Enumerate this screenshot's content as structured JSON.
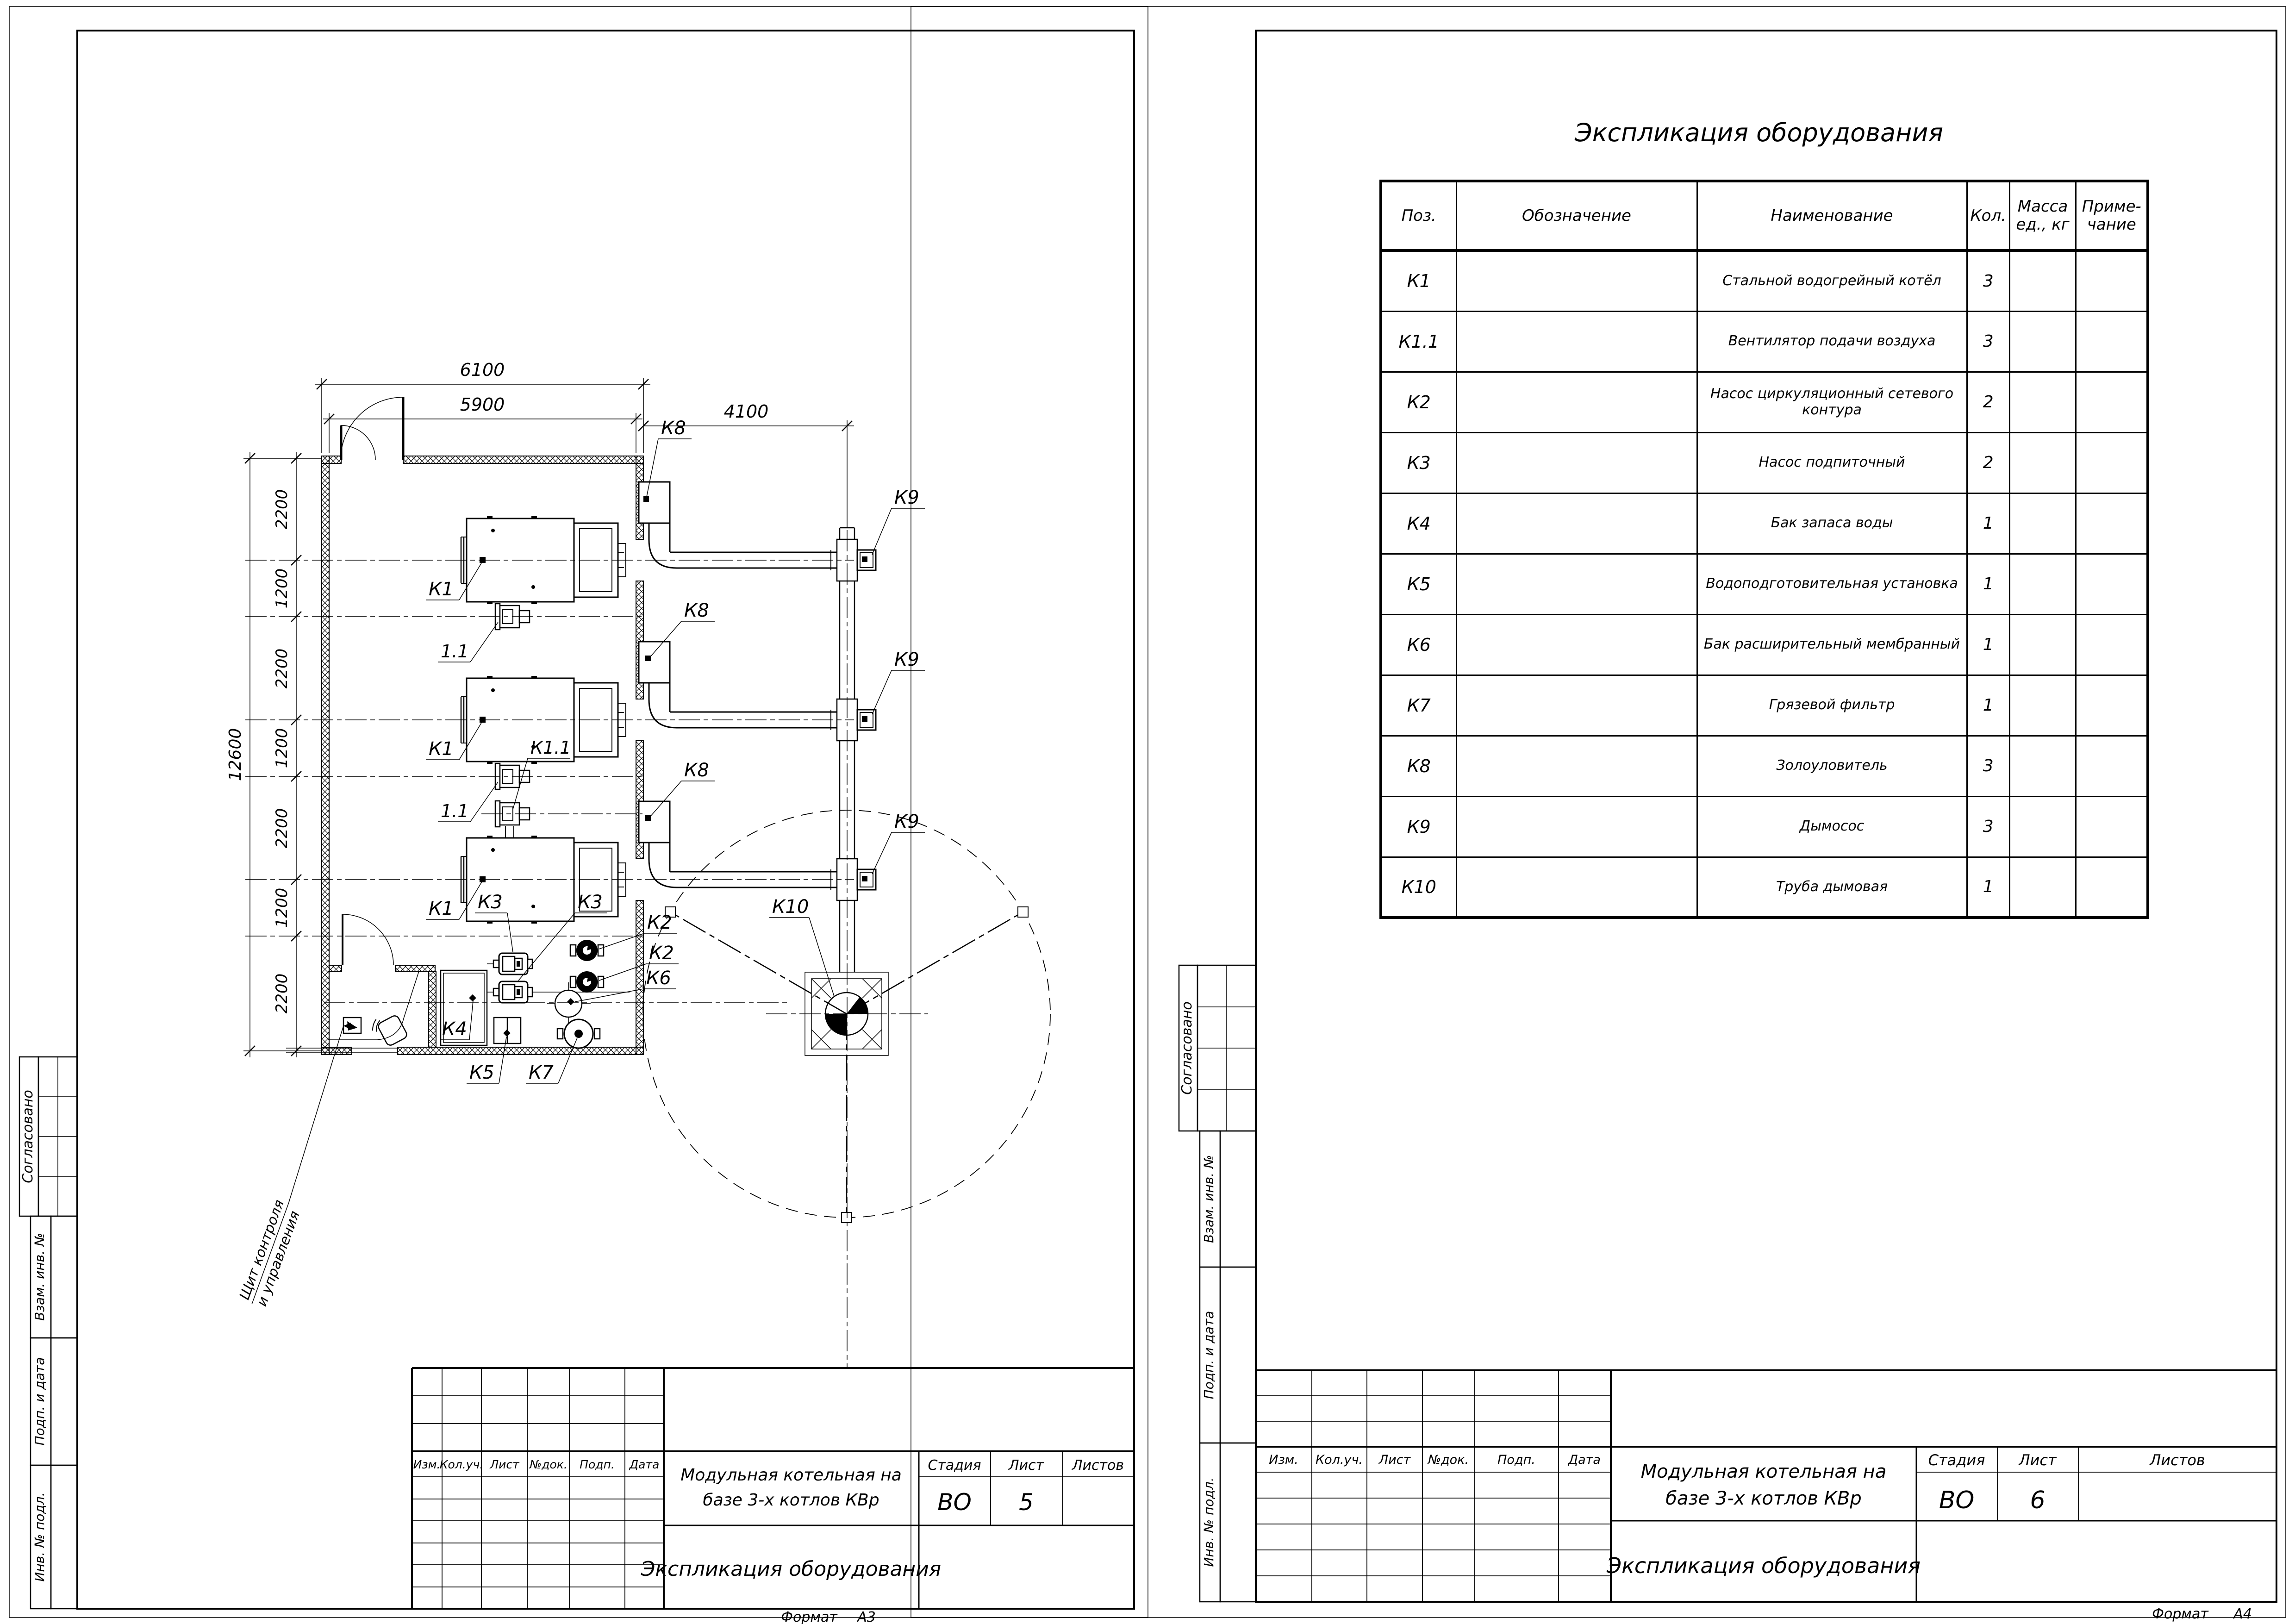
{
  "left_sheet": {
    "side_stamps": [
      "Согласовано",
      "Взам. инв. №",
      "Подп. и дата",
      "Инв. № подл."
    ],
    "format": {
      "label": "Формат",
      "value": "А3"
    },
    "title_block": {
      "columns": [
        "Изм.",
        "Кол.уч.",
        "Лист",
        "№док.",
        "Подп.",
        "Дата"
      ],
      "object": "Модульная котельная на базе 3-х котлов КВр",
      "object_line1": "Модульная котельная на",
      "object_line2": "базе 3-х котлов КВр",
      "doc": "Экспликация оборудования",
      "stage_label": "Стадия",
      "sheet_label": "Лист",
      "sheets_label": "Листов",
      "stage": "ВО",
      "sheet_no": "5",
      "sheets_total": ""
    },
    "plan": {
      "dim_width_outer": "6100",
      "dim_width_inner": "5900",
      "dim_chimney": "4100",
      "dim_total": "12600",
      "dim_chain": [
        "2200",
        "1200",
        "2200",
        "1200",
        "2200",
        "1200",
        "2200"
      ],
      "labels": {
        "boiler": "К1",
        "fan": "1.1",
        "fan_k": "К1.1",
        "ash_collector": "К8",
        "smoke_exhauster": "К9",
        "chimney": "К10",
        "network_pump": "К2",
        "feed_pump": "К3",
        "water_tank": "К4",
        "water_treatment": "К5",
        "expansion_tank": "К6",
        "mud_filter": "К7"
      },
      "annotation_line1": "Щит контроля",
      "annotation_line2": "и управления"
    }
  },
  "right_sheet": {
    "side_stamps": [
      "Согласовано",
      "Взам. инв. №",
      "Подп. и дата",
      "Инв. № подл."
    ],
    "format": {
      "label": "Формат",
      "value": "А4"
    },
    "title_block": {
      "columns": [
        "Изм.",
        "Кол.уч.",
        "Лист",
        "№док.",
        "Подп.",
        "Дата"
      ],
      "object_line1": "Модульная котельная на",
      "object_line2": "базе 3-х котлов КВр",
      "doc": "Экспликация оборудования",
      "stage_label": "Стадия",
      "sheet_label": "Лист",
      "sheets_label": "Листов",
      "stage": "ВО",
      "sheet_no": "6",
      "sheets_total": ""
    },
    "table": {
      "title": "Экспликация оборудования",
      "headers": {
        "pos": "Поз.",
        "designation": "Обозначение",
        "name": "Наименование",
        "qty": "Кол.",
        "mass1": "Масса",
        "mass2": "ед., кг",
        "note1": "Приме-",
        "note2": "чание"
      },
      "rows": [
        {
          "pos": "К1",
          "designation": "",
          "name": "Стальной водогрейный котёл",
          "qty": "3",
          "mass": "",
          "note": ""
        },
        {
          "pos": "К1.1",
          "designation": "",
          "name": "Вентилятор подачи воздуха",
          "qty": "3",
          "mass": "",
          "note": ""
        },
        {
          "pos": "К2",
          "designation": "",
          "name": "Насос циркуляционный сетевого контура",
          "qty": "2",
          "mass": "",
          "note": ""
        },
        {
          "pos": "К3",
          "designation": "",
          "name": "Насос подпиточный",
          "qty": "2",
          "mass": "",
          "note": ""
        },
        {
          "pos": "К4",
          "designation": "",
          "name": "Бак запаса воды",
          "qty": "1",
          "mass": "",
          "note": ""
        },
        {
          "pos": "К5",
          "designation": "",
          "name": "Водоподготовительная установка",
          "qty": "1",
          "mass": "",
          "note": ""
        },
        {
          "pos": "К6",
          "designation": "",
          "name": "Бак расширительный мембранный",
          "qty": "1",
          "mass": "",
          "note": ""
        },
        {
          "pos": "К7",
          "designation": "",
          "name": "Грязевой фильтр",
          "qty": "1",
          "mass": "",
          "note": ""
        },
        {
          "pos": "К8",
          "designation": "",
          "name": "Золоуловитель",
          "qty": "3",
          "mass": "",
          "note": ""
        },
        {
          "pos": "К9",
          "designation": "",
          "name": "Дымосос",
          "qty": "3",
          "mass": "",
          "note": ""
        },
        {
          "pos": "К10",
          "designation": "",
          "name": "Труба дымовая",
          "qty": "1",
          "mass": "",
          "note": ""
        }
      ]
    }
  }
}
